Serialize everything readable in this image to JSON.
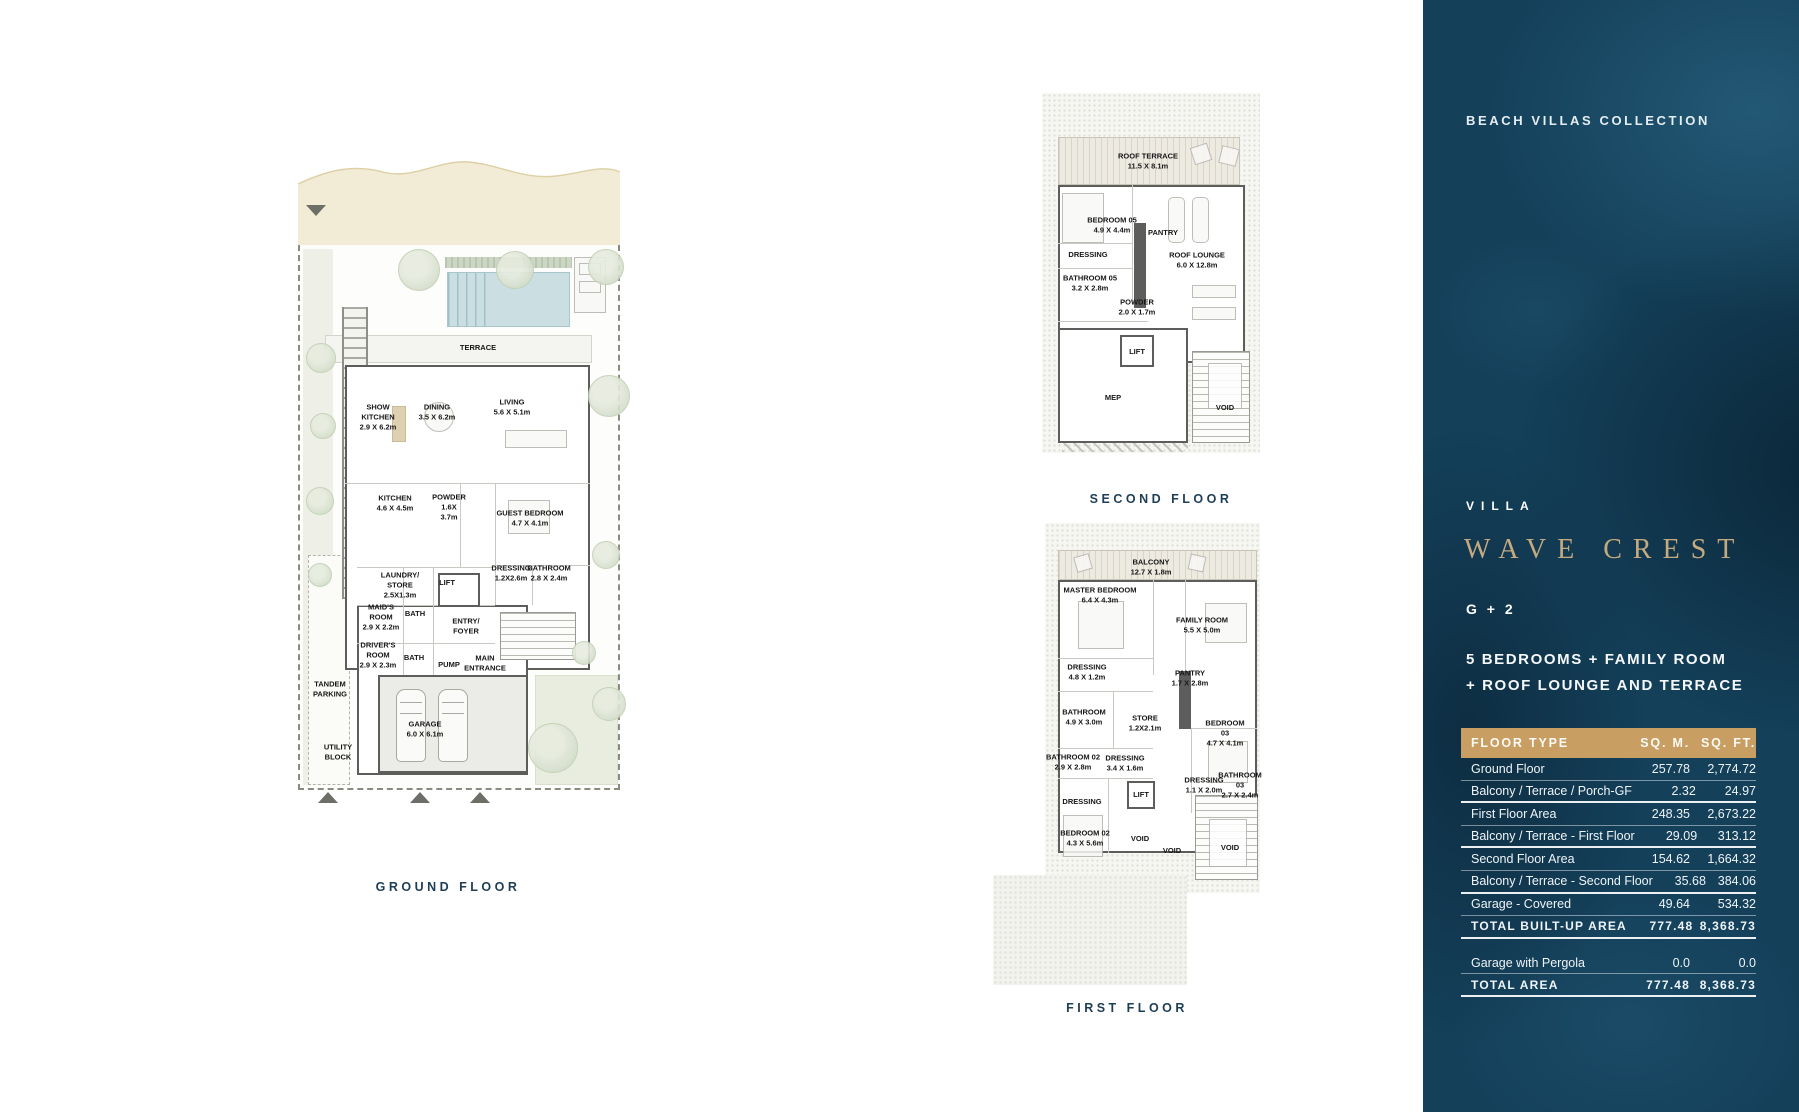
{
  "sidebar": {
    "collection": "BEACH VILLAS COLLECTION",
    "villa_label": "VILLA",
    "villa_name": "WAVE CREST",
    "config": "G + 2",
    "description_line1": "5 BEDROOMS + FAMILY ROOM",
    "description_line2": "+ ROOF LOUNGE AND TERRACE",
    "colors": {
      "panel_bg": "#14405a",
      "table_header_bg": "#c89e63",
      "villa_name_gold": "#c4aa7e",
      "caption_navy": "#1e3e56"
    },
    "table": {
      "headers": {
        "type": "FLOOR TYPE",
        "sqm": "SQ. M.",
        "sqft": "SQ. FT."
      },
      "rows": [
        {
          "label": "Ground Floor",
          "sqm": "257.78",
          "sqft": "2,774.72"
        },
        {
          "label": "Balcony / Terrace / Porch-GF",
          "sqm": "2.32",
          "sqft": "24.97"
        },
        {
          "label": "First Floor Area",
          "sqm": "248.35",
          "sqft": "2,673.22"
        },
        {
          "label": "Balcony / Terrace - First Floor",
          "sqm": "29.09",
          "sqft": "313.12"
        },
        {
          "label": "Second Floor Area",
          "sqm": "154.62",
          "sqft": "1,664.32"
        },
        {
          "label": "Balcony / Terrace - Second Floor",
          "sqm": "35.68",
          "sqft": "384.06"
        },
        {
          "label": "Garage - Covered",
          "sqm": "49.64",
          "sqft": "534.32"
        },
        {
          "label": "TOTAL BUILT-UP AREA",
          "sqm": "777.48",
          "sqft": "8,368.73"
        },
        {
          "label": "Garage with Pergola",
          "sqm": "0.0",
          "sqft": "0.0"
        },
        {
          "label": "TOTAL AREA",
          "sqm": "777.48",
          "sqft": "8,368.73"
        }
      ]
    }
  },
  "plans": {
    "ground": {
      "caption": "GROUND FLOOR",
      "rooms": [
        {
          "label": "TERRACE"
        },
        {
          "label": "SHOW\nKITCHEN\n2.9 X 6.2m"
        },
        {
          "label": "DINING\n3.5 X 6.2m"
        },
        {
          "label": "LIVING\n5.6 X 5.1m"
        },
        {
          "label": "KITCHEN\n4.6 X 4.5m"
        },
        {
          "label": "POWDER\n1.6X\n3.7m"
        },
        {
          "label": "GUEST BEDROOM\n4.7 X 4.1m"
        },
        {
          "label": "DRESSING\n1.2X2.6m"
        },
        {
          "label": "BATHROOM\n2.8 X 2.4m"
        },
        {
          "label": "LAUNDRY/\nSTORE\n2.5X1.3m"
        },
        {
          "label": "LIFT"
        },
        {
          "label": "MAID'S\nROOM\n2.9 X 2.2m"
        },
        {
          "label": "BATH"
        },
        {
          "label": "ENTRY/\nFOYER"
        },
        {
          "label": "DRIVER'S\nROOM\n2.9 X 2.3m"
        },
        {
          "label": "BATH"
        },
        {
          "label": "PUMP"
        },
        {
          "label": "MAIN\nENTRANCE"
        },
        {
          "label": "TANDEM\nPARKING"
        },
        {
          "label": "GARAGE\n6.0 X 6.1m"
        },
        {
          "label": "UTILITY\nBLOCK"
        }
      ]
    },
    "second": {
      "caption": "SECOND FLOOR",
      "rooms": [
        {
          "label": "ROOF TERRACE\n11.5 X 8.1m"
        },
        {
          "label": "BEDROOM 05\n4.9 X 4.4m"
        },
        {
          "label": "PANTRY"
        },
        {
          "label": "DRESSING"
        },
        {
          "label": "ROOF LOUNGE\n6.0 X 12.8m"
        },
        {
          "label": "BATHROOM 05\n3.2 X 2.8m"
        },
        {
          "label": "POWDER\n2.0 X 1.7m"
        },
        {
          "label": "LIFT"
        },
        {
          "label": "MEP"
        },
        {
          "label": "VOID"
        }
      ]
    },
    "first": {
      "caption": "FIRST FLOOR",
      "rooms": [
        {
          "label": "BALCONY\n12.7 X 1.8m"
        },
        {
          "label": "MASTER BEDROOM\n6.4 X 4.3m"
        },
        {
          "label": "FAMILY ROOM\n5.5 X 5.0m"
        },
        {
          "label": "DRESSING\n4.8 X 1.2m"
        },
        {
          "label": "PANTRY\n1.7 X 2.8m"
        },
        {
          "label": "BATHROOM\n4.9 X 3.0m"
        },
        {
          "label": "STORE\n1.2X2.1m"
        },
        {
          "label": "BEDROOM 03\n4.7 X 4.1m"
        },
        {
          "label": "BATHROOM 02\n2.9 X 2.8m"
        },
        {
          "label": "DRESSING\n3.4 X 1.6m"
        },
        {
          "label": "DRESSING\n1.1 X 2.0m"
        },
        {
          "label": "BATHROOM 03\n2.7 X 2.4m"
        },
        {
          "label": "DRESSING"
        },
        {
          "label": "LIFT"
        },
        {
          "label": "BEDROOM 02\n4.3 X 5.6m"
        },
        {
          "label": "VOID"
        },
        {
          "label": "VOID"
        },
        {
          "label": "VOID"
        }
      ]
    }
  }
}
